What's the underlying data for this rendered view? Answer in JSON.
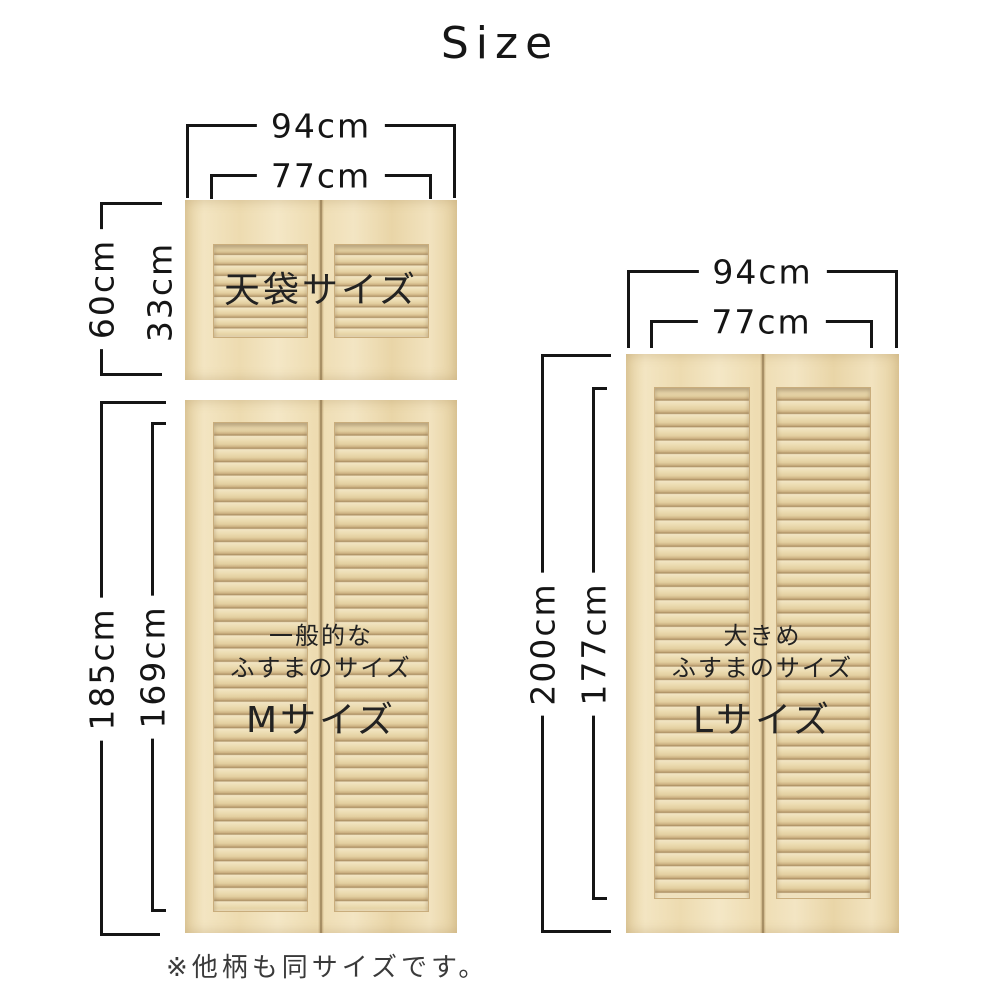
{
  "title": "Size",
  "note": "※他柄も同サイズです。",
  "doors": {
    "tenbukuro": {
      "name_label": "天袋サイズ",
      "outer_width": "94cm",
      "inner_width": "77cm",
      "outer_height": "60cm",
      "inner_height": "33cm"
    },
    "m": {
      "desc_line1": "一般的な",
      "desc_line2": "ふすまのサイズ",
      "size_label": "Mサイズ",
      "outer_height": "185cm",
      "inner_height": "169cm"
    },
    "l": {
      "desc_line1": "大きめ",
      "desc_line2": "ふすまのサイズ",
      "size_label": "Lサイズ",
      "outer_width": "94cm",
      "inner_width": "77cm",
      "outer_height": "200cm",
      "inner_height": "177cm"
    }
  },
  "colors": {
    "dimension_line": "#151515",
    "door_text": "#222222",
    "wood_base": "#efdfb6",
    "background": "#ffffff"
  }
}
